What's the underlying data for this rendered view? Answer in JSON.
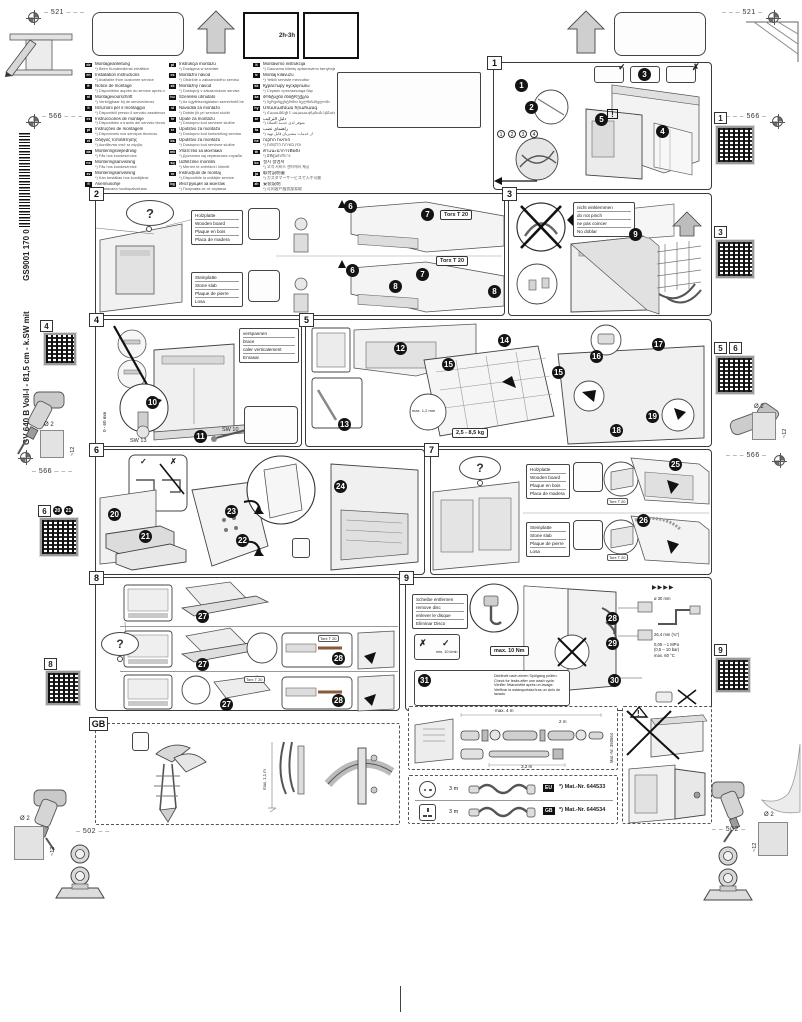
{
  "glyphs": {
    "question": "?",
    "check": "✓",
    "cross": "✗",
    "warning": "!",
    "arrows": "▶▶▶▶"
  },
  "header": {
    "dim_top": "521",
    "dim_side": "566",
    "dim_bottom": "502",
    "time_badge": "2h-3h"
  },
  "margins": {
    "model_line": "GV 640 B Voll-I - 81,5 cm - k.SW mit",
    "doc_number": "GS9001 170 055 (9812)",
    "drill_dia": "Ø 2",
    "drill_depth": "~12",
    "qr": {
      "r1": "1",
      "r2": "3",
      "r3a": "5",
      "r3b": "6",
      "r4": "9",
      "l1": "4",
      "l2": "6",
      "l2s1": "20",
      "l2s2": "21",
      "l3": "8"
    }
  },
  "languages": {
    "col1": [
      {
        "c": "de",
        "t": "Montageanleitung",
        "s": "*) Beim Kundendienst erhältlich"
      },
      {
        "c": "en",
        "t": "Installation instructions",
        "s": "*) Available from customer service"
      },
      {
        "c": "fr",
        "t": "Notice de montage",
        "s": "*) Disponibles auprès du service après-vente"
      },
      {
        "c": "nl",
        "t": "Montagevoorschrift",
        "s": "*) Verkrijgbaar bij de servicedienst"
      },
      {
        "c": "it",
        "t": "Istruzioni per il montaggio",
        "s": "*) Disponibili presso il servizio assistenza"
      },
      {
        "c": "es",
        "t": "Instrucciones de montaje",
        "s": "*) Disponibles a través del servicio técnico"
      },
      {
        "c": "pt",
        "t": "Instruções de montagem",
        "s": "*) Disponíveis nos serviços técnicos"
      },
      {
        "c": "el",
        "t": "Οδηγίες τοποθέτησης",
        "s": "*) Διατίθενται από το σέρβις"
      },
      {
        "c": "da",
        "t": "Monteringsvejledning",
        "s": "*) Fås hos kundeservice"
      },
      {
        "c": "no",
        "t": "Monteringsanvisning",
        "s": "*) Fås hos kundeservice"
      },
      {
        "c": "sv",
        "t": "Monteringsanvisning",
        "s": "*) Kan beställas hos kundtjänst"
      },
      {
        "c": "fi",
        "t": "Asennusohje",
        "s": "*) Saatavana huoltopalvelusta"
      }
    ],
    "col2": [
      {
        "c": "pl",
        "t": "Instrukcja montażu",
        "s": "*) Dostępna w serwisie"
      },
      {
        "c": "cs",
        "t": "Montážní návod",
        "s": "*) Obdržíte u zákaznického servisu"
      },
      {
        "c": "sk",
        "t": "Montážny návod",
        "s": "*) Dostupný v zákazníckom servise"
      },
      {
        "c": "hu",
        "t": "Szerelési útmutató",
        "s": "*) Az ügyfélszolgálaton szerezhető be"
      },
      {
        "c": "sl",
        "t": "Navodila za montažo",
        "s": "*) Dobite jih pri servisni službi"
      },
      {
        "c": "hr",
        "t": "Upute za montažu",
        "s": "*) Dostupno kod servisne službe"
      },
      {
        "c": "sr",
        "t": "Uputstvo za montažu",
        "s": "*) Dostupno kod korisničkog servisa"
      },
      {
        "c": "bs",
        "t": "Uputstvo za montažu",
        "s": "*) Dostupno kod servisne službe"
      },
      {
        "c": "mk",
        "t": "Упатство за монтажа",
        "s": "*) Достапно кај сервисната служба"
      },
      {
        "c": "sq",
        "t": "Udhëzime montimi",
        "s": "*) Merren te shërbimi i klientit"
      },
      {
        "c": "ro",
        "t": "Instrucţiuni de montaj",
        "s": "*) Disponibile la unităţile service"
      },
      {
        "c": "bg",
        "t": "Инструкция за монтаж",
        "s": "*) Получава се от сервиза"
      },
      {
        "c": "uk",
        "t": "Інструкція з монтажу",
        "s": "*) Можна отримати в сервісному центрі"
      },
      {
        "c": "ru",
        "t": "Инструкция по монтажу",
        "s": "*) Можно получить в сервисной службе"
      },
      {
        "c": "et",
        "t": "Paigaldusjuhend",
        "s": "*) Saadaval klienditeenindusest"
      },
      {
        "c": "lv",
        "t": "Montāžas instrukcija",
        "s": "*) Pieejama klientu servisā"
      }
    ],
    "col3": [
      {
        "c": "lt",
        "t": "Montavimo instrukcija",
        "s": "*) Gaunama klientų aptarnavimo tarnyboje"
      },
      {
        "c": "tr",
        "t": "Montaj kılavuzu",
        "s": "*) Yetkili serviste mevcuttur"
      },
      {
        "c": "kk",
        "t": "Құрастыру нұсқаулығы",
        "s": "*) Сервис орталығында бар"
      },
      {
        "c": "ka",
        "t": "მონტაჟის ინსტრუქცია",
        "s": "*) სერვისცენტრშია ხელმისაწვდომი"
      },
      {
        "c": "hy",
        "t": "Մոնտաժման հրահանգ",
        "s": "*) Հասանելի է սպասարկման կենտրոնում"
      },
      {
        "c": "ar",
        "t": "دليل التركيب",
        "s": "*) متوفر لدى خدمة العملاء"
      },
      {
        "c": "fa",
        "t": "راهنمای نصب",
        "s": "*) از خدمات مشتریان قابل تهیه"
      },
      {
        "c": "he",
        "t": "הוראות התקנה",
        "s": "*) זמין בשירות הלקוחות"
      },
      {
        "c": "th",
        "t": "คำแนะนำการติดตั้ง",
        "s": "*) มีที่ศูนย์บริการ"
      },
      {
        "c": "ko",
        "t": "설치 설명서",
        "s": "*) 고객 서비스 센터에서 제공"
      },
      {
        "c": "ja",
        "t": "取付説明書",
        "s": "*) カスタマーサービスで入手可能"
      },
      {
        "c": "zh",
        "t": "安装说明",
        "s": "*) 可向客户服务部索取"
      },
      {
        "c": "tw",
        "t": "安裝說明",
        "s": "*) 可向客戶服務部索取"
      }
    ]
  },
  "panels": {
    "p1": {
      "num": "1",
      "steps": [
        "1",
        "2",
        "3",
        "4",
        "5"
      ],
      "parts": [
        "1",
        "2",
        "3",
        "4"
      ]
    },
    "p2": {
      "num": "2",
      "torx": "Torx T 20",
      "steps": [
        "6",
        "7",
        "8"
      ],
      "wood": [
        "Holzplatte",
        "Wooden board",
        "Plaque en bois",
        "Placa de madera"
      ],
      "stone": [
        "Steinplatte",
        "Stone slab",
        "Plaque de pierre",
        "Losa"
      ]
    },
    "p3": {
      "num": "3",
      "steps": [
        "9"
      ],
      "warning": [
        "nicht einklemmen",
        "do not pinch",
        "ne pas coincer",
        "No doblar"
      ]
    },
    "p4": {
      "num": "4",
      "steps": [
        "10",
        "11"
      ],
      "range": "0 - 60 mm",
      "sw13": "SW 13",
      "sw10": "SW 10",
      "brace": [
        "verspannen",
        "brace",
        "caler verticalement",
        "Enrasar"
      ]
    },
    "p5": {
      "num": "5",
      "steps": [
        "12",
        "13",
        "14",
        "15",
        "16",
        "17",
        "18",
        "19"
      ],
      "weight": "2,5 - 8,5 kg",
      "gap": "max. 1,2 mm"
    },
    "p6": {
      "num": "6",
      "steps": [
        "20",
        "21",
        "22",
        "23",
        "24"
      ]
    },
    "p7": {
      "num": "7",
      "torx": "Torx T 20",
      "steps": [
        "25",
        "26"
      ],
      "wood": [
        "Holzplatte",
        "Wooden board",
        "Plaque en bois",
        "Placa de madera"
      ],
      "stone": [
        "Steinplatte",
        "Stone slab",
        "Plaque de pierre",
        "Losa"
      ]
    },
    "p8": {
      "num": "8",
      "torx": "Torx T 20",
      "steps": [
        "27",
        "28"
      ]
    },
    "p9": {
      "num": "9",
      "steps": [
        "28",
        "29",
        "30",
        "31"
      ],
      "torque": "max. 10 Nm",
      "remove": [
        "Scheibe entfernen",
        "remove disc",
        "enlever le disque",
        "Eliminar Disco"
      ],
      "leak": [
        "Dichtheit nach einem Spülgang prüfen.",
        "Check for leaks after one wash cycle.",
        "Vérifier l'étanchéité après un lavage.",
        "Verificar la estanqueidad tras un ciclo de lavado."
      ],
      "spec_dia": "ø 30 mm",
      "spec_conn": "26,4 mm (¾\")",
      "spec_pressure": [
        "0,05 – 1 MPa",
        "(0,5 – 10 bar)",
        "max. 60 °C"
      ],
      "spec_flow": "min. 10 l/min"
    }
  },
  "gb": {
    "tag": "GB",
    "height": "max. 1,1 m"
  },
  "hose": {
    "max_total": "max. 4 m",
    "len_a": "2 m",
    "len_b": "3,2 m",
    "mat": "Mat.-Nr. 350564"
  },
  "cords": {
    "rows": [
      {
        "len": "3 m",
        "tag": "EU",
        "mat": "*) Mat.-Nr. 644533"
      },
      {
        "len": "3 m",
        "tag": "GB",
        "mat": "*) Mat.-Nr. 644534"
      }
    ]
  }
}
